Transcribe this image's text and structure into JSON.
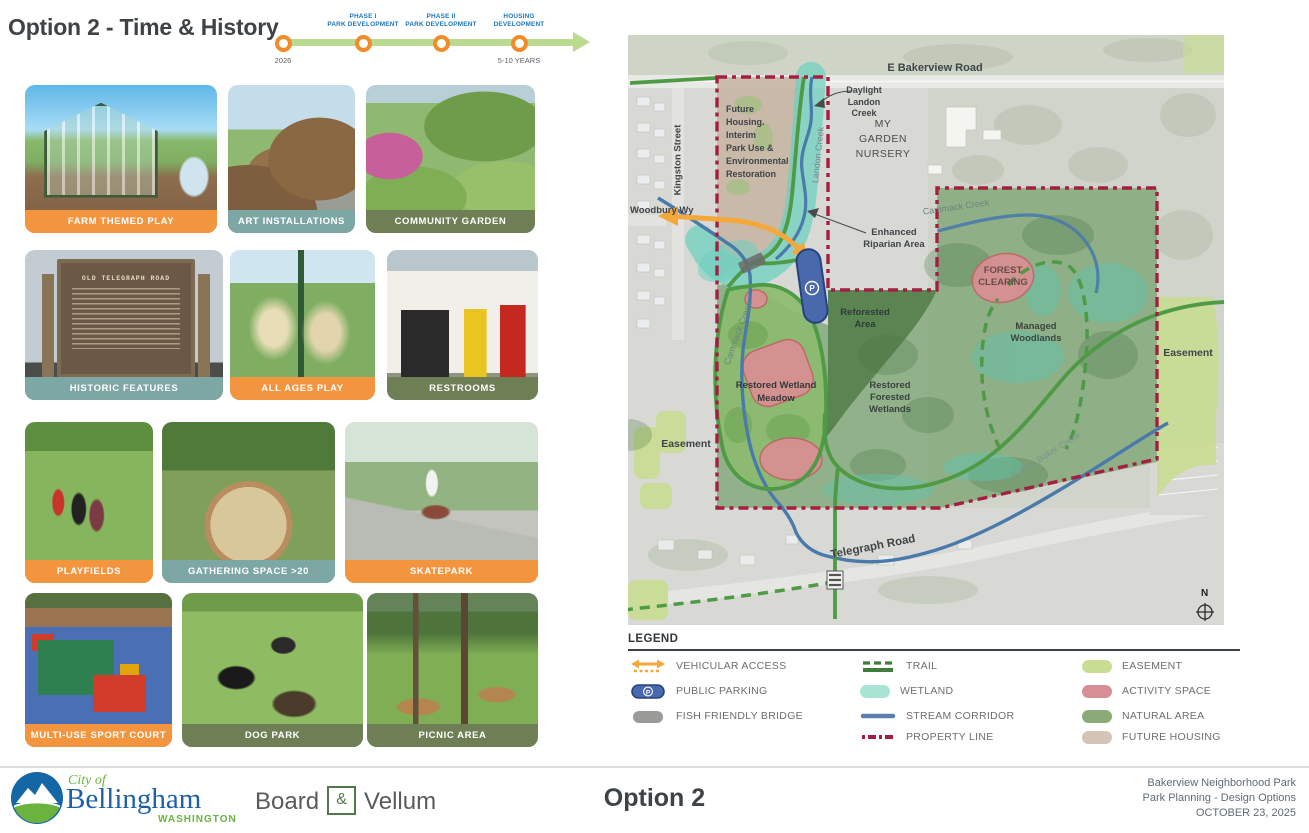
{
  "header": {
    "title": "Option 2 - Time & History"
  },
  "timeline": {
    "start_year": "2026",
    "end_duration": "5-10 YEARS",
    "milestones": [
      "PHASE I\nPARK DEVELOPMENT",
      "PHASE II\nPARK DEVELOPMENT",
      "HOUSING\nDEVELOPMENT"
    ]
  },
  "cards": [
    {
      "label": "FARM THEMED PLAY"
    },
    {
      "label": "ART INSTALLATIONS"
    },
    {
      "label": "COMMUNITY GARDEN"
    },
    {
      "label": "HISTORIC FEATURES"
    },
    {
      "label": "ALL AGES PLAY"
    },
    {
      "label": "RESTROOMS"
    },
    {
      "label": "PLAYFIELDS"
    },
    {
      "label": "GATHERING SPACE >20"
    },
    {
      "label": "SKATEPARK"
    },
    {
      "label": "MULTI-USE SPORT COURT"
    },
    {
      "label": "DOG PARK"
    },
    {
      "label": "PICNIC AREA"
    }
  ],
  "historic_sign": {
    "title": "OLD TELEGRAPH ROAD"
  },
  "map": {
    "labels": {
      "bakerview": "E Bakerview Road",
      "kingston": "Kingston Street",
      "woodbury": "Woodbury Wy",
      "telegraph": "Telegraph Road",
      "nursery": "MY\nGARDEN\nNURSERY",
      "daylight": "Daylight\nLandon\nCreek",
      "landon_creek": "Landon Creek",
      "future_housing": "Future\nHousing.\nInterim\nPark Use &\nEnvironmental\nRestoration",
      "enhanced_riparian": "Enhanced\nRiparian Area",
      "cammack_west": "Cammack Creek",
      "cammack_east": "Cammack Creek",
      "forest_clearing": "FOREST\nCLEARING",
      "reforested": "Reforested\nArea",
      "managed": "Managed\nWoodlands",
      "restored_forested": "Restored\nForested\nWetlands",
      "restored_meadow": "Restored Wetland\nMeadow",
      "easement_left": "Easement",
      "easement_right": "Easement",
      "n_fork": "N Fork Baker Creek",
      "parking": "P",
      "north": "N"
    }
  },
  "legend": {
    "title": "LEGEND",
    "col1": [
      "VEHICULAR ACCESS",
      "PUBLIC PARKING",
      "FISH FRIENDLY BRIDGE"
    ],
    "col2": [
      "TRAIL",
      "WETLAND",
      "STREAM CORRIDOR",
      "PROPERTY LINE"
    ],
    "col3": [
      "EASEMENT",
      "ACTIVITY SPACE",
      "NATURAL AREA",
      "FUTURE HOUSING"
    ]
  },
  "footer": {
    "city_small": "City of",
    "city": "Bellingham",
    "state": "WASHINGTON",
    "firm_word1": "Board",
    "firm_amp": "&",
    "firm_word2": "Vellum",
    "option": "Option 2",
    "project": "Bakerview Neighborhood Park",
    "subtitle": "Park Planning - Design Options",
    "date": "OCTOBER 23, 2025"
  },
  "colors": {
    "label_orange": "#F3953F",
    "label_teal": "#7DA7A4",
    "label_olive": "#6E7F55",
    "timeline_blue": "#1B75BC",
    "timeline_green": "#B9DA8F",
    "milestone_ring": "#F28C2B",
    "property_line": "#A51E41",
    "trail_green": "#4E9A45",
    "stream_blue": "#4A7AAB",
    "wetland_teal": "#6FD0BF",
    "easement_green": "#C9DD92",
    "activity_pink": "#D98F93",
    "natural_green": "#63965A",
    "future_housing_tan": "#C7B6A5",
    "parking_blue": "#4A69AC",
    "vehicular_orange": "#F5A73B",
    "bellingham_blue": "#1E5FA8",
    "bellingham_green": "#69B33E"
  }
}
